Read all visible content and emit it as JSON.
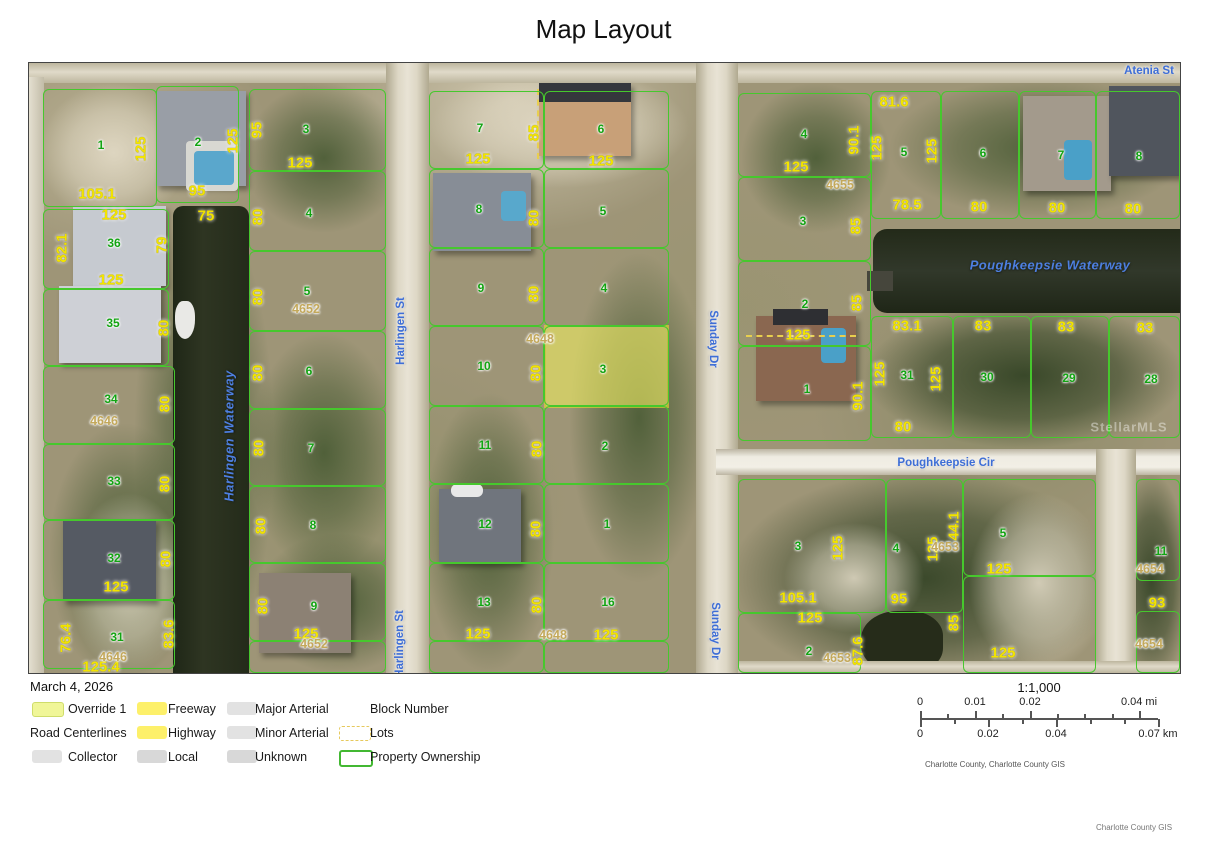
{
  "title": "Map Layout",
  "date": "March 4, 2026",
  "credits": {
    "map": "Charlotte County, Charlotte County GIS",
    "page": "Charlotte County GIS"
  },
  "scale_bar": {
    "ratio": "1:1,000",
    "mi_ticks": [
      "0",
      "0.01",
      "0.02",
      "0.04 mi"
    ],
    "km_ticks": [
      "0",
      "0.02",
      "0.04",
      "0.07 km"
    ]
  },
  "legend": {
    "rows": [
      [
        {
          "label": "Override 1",
          "swatch": "override"
        },
        {
          "label": "Freeway",
          "swatch": "yellow"
        },
        {
          "label": "Major Arterial",
          "swatch": "gray"
        },
        {
          "label": "Block Number",
          "swatch": "none"
        }
      ],
      [
        {
          "label": "Road Centerlines",
          "swatch": "title"
        },
        {
          "label": "Highway",
          "swatch": "yellow"
        },
        {
          "label": "Minor Arterial",
          "swatch": "gray"
        },
        {
          "label": "Lots",
          "swatch": "dashed"
        }
      ],
      [
        {
          "label": "Collector",
          "swatch": "gray"
        },
        {
          "label": "Local",
          "swatch": "gray2"
        },
        {
          "label": "Unknown",
          "swatch": "gray2"
        },
        {
          "label": "Property Ownership",
          "swatch": "green-outline"
        }
      ]
    ]
  },
  "colors": {
    "parcel_line": "#46c82d",
    "highlight_fill": "#ecea62",
    "highlight_border": "#e6df2e",
    "dimension_text": "#f2e400",
    "lot_number_text": "#12a412",
    "block_number_text": "#c3a85a",
    "street_text": "#3e6ed6",
    "water_text": "#4d7fe0",
    "water": "#262d1b",
    "legend_yellow": "#fdf06a",
    "legend_gray": "#e2e2e2"
  },
  "map": {
    "watermark": {
      "t": "StellarMLS",
      "x": 1100,
      "y": 364
    },
    "streets": [
      {
        "t": "Harlingen St",
        "x": 372,
        "y": 268,
        "r": -90
      },
      {
        "t": "Harlingen St",
        "x": 371,
        "y": 581,
        "r": -90
      },
      {
        "t": "Sunday Dr",
        "x": 684,
        "y": 276,
        "r": 90
      },
      {
        "t": "Sunday Dr",
        "x": 686,
        "y": 568,
        "r": 90
      },
      {
        "t": "Atenia St",
        "x": 1120,
        "y": 8,
        "r": 0
      },
      {
        "t": "Poughkeepsie Cir",
        "x": 917,
        "y": 400,
        "r": 0
      }
    ],
    "water_labels": [
      {
        "t": "Harlingen Waterway",
        "x": 200,
        "y": 373,
        "r": -90
      },
      {
        "t": "Poughkeepsie Waterway",
        "x": 1021,
        "y": 202,
        "r": 0
      }
    ],
    "lot_numbers": [
      {
        "t": "1",
        "x": 72,
        "y": 82
      },
      {
        "t": "2",
        "x": 169,
        "y": 79
      },
      {
        "t": "36",
        "x": 85,
        "y": 180
      },
      {
        "t": "35",
        "x": 84,
        "y": 260
      },
      {
        "t": "34",
        "x": 82,
        "y": 336
      },
      {
        "t": "33",
        "x": 85,
        "y": 418
      },
      {
        "t": "32",
        "x": 85,
        "y": 495
      },
      {
        "t": "31",
        "x": 88,
        "y": 574
      },
      {
        "t": "3",
        "x": 277,
        "y": 66
      },
      {
        "t": "4",
        "x": 280,
        "y": 150
      },
      {
        "t": "5",
        "x": 278,
        "y": 228
      },
      {
        "t": "6",
        "x": 280,
        "y": 308
      },
      {
        "t": "7",
        "x": 282,
        "y": 385
      },
      {
        "t": "8",
        "x": 284,
        "y": 462
      },
      {
        "t": "9",
        "x": 285,
        "y": 543
      },
      {
        "t": "7",
        "x": 451,
        "y": 65
      },
      {
        "t": "8",
        "x": 450,
        "y": 146
      },
      {
        "t": "9",
        "x": 452,
        "y": 225
      },
      {
        "t": "10",
        "x": 455,
        "y": 303
      },
      {
        "t": "11",
        "x": 456,
        "y": 382
      },
      {
        "t": "12",
        "x": 456,
        "y": 461
      },
      {
        "t": "13",
        "x": 455,
        "y": 539
      },
      {
        "t": "6",
        "x": 572,
        "y": 66
      },
      {
        "t": "5",
        "x": 574,
        "y": 148
      },
      {
        "t": "4",
        "x": 575,
        "y": 225
      },
      {
        "t": "3",
        "x": 574,
        "y": 306
      },
      {
        "t": "2",
        "x": 576,
        "y": 383
      },
      {
        "t": "1",
        "x": 578,
        "y": 461
      },
      {
        "t": "16",
        "x": 579,
        "y": 539
      },
      {
        "t": "4",
        "x": 775,
        "y": 71
      },
      {
        "t": "3",
        "x": 774,
        "y": 158
      },
      {
        "t": "2",
        "x": 776,
        "y": 241
      },
      {
        "t": "1",
        "x": 778,
        "y": 326
      },
      {
        "t": "5",
        "x": 875,
        "y": 89
      },
      {
        "t": "6",
        "x": 954,
        "y": 90
      },
      {
        "t": "7",
        "x": 1032,
        "y": 92
      },
      {
        "t": "8",
        "x": 1110,
        "y": 93
      },
      {
        "t": "31",
        "x": 878,
        "y": 312
      },
      {
        "t": "30",
        "x": 958,
        "y": 314
      },
      {
        "t": "29",
        "x": 1040,
        "y": 315
      },
      {
        "t": "28",
        "x": 1122,
        "y": 316
      },
      {
        "t": "3",
        "x": 769,
        "y": 483
      },
      {
        "t": "4",
        "x": 867,
        "y": 485
      },
      {
        "t": "5",
        "x": 974,
        "y": 470
      },
      {
        "t": "2",
        "x": 780,
        "y": 588
      },
      {
        "t": "11",
        "x": 1132,
        "y": 488
      }
    ],
    "dimensions": [
      {
        "t": "125",
        "x": 112,
        "y": 86,
        "r": -90
      },
      {
        "t": "105.1",
        "x": 68,
        "y": 131
      },
      {
        "t": "95",
        "x": 168,
        "y": 128
      },
      {
        "t": "125",
        "x": 204,
        "y": 78,
        "r": -90
      },
      {
        "t": "75",
        "x": 177,
        "y": 153
      },
      {
        "t": "82.1",
        "x": 33,
        "y": 185,
        "r": -90
      },
      {
        "t": "125",
        "x": 85,
        "y": 152
      },
      {
        "t": "125",
        "x": 82,
        "y": 217
      },
      {
        "t": "79",
        "x": 133,
        "y": 182,
        "r": -90
      },
      {
        "t": "80",
        "x": 135,
        "y": 265,
        "r": -90
      },
      {
        "t": "80",
        "x": 136,
        "y": 341,
        "r": -90
      },
      {
        "t": "80",
        "x": 136,
        "y": 421,
        "r": -90
      },
      {
        "t": "80",
        "x": 137,
        "y": 496,
        "r": -90
      },
      {
        "t": "125",
        "x": 87,
        "y": 524
      },
      {
        "t": "76.4",
        "x": 37,
        "y": 575,
        "r": -90
      },
      {
        "t": "83.6",
        "x": 140,
        "y": 571,
        "r": -90
      },
      {
        "t": "125.4",
        "x": 72,
        "y": 604
      },
      {
        "t": "95",
        "x": 228,
        "y": 67,
        "r": -90
      },
      {
        "t": "125",
        "x": 271,
        "y": 100
      },
      {
        "t": "80",
        "x": 229,
        "y": 154,
        "r": -90
      },
      {
        "t": "80",
        "x": 229,
        "y": 234,
        "r": -90
      },
      {
        "t": "80",
        "x": 229,
        "y": 310,
        "r": -90
      },
      {
        "t": "80",
        "x": 230,
        "y": 385,
        "r": -90
      },
      {
        "t": "80",
        "x": 232,
        "y": 463,
        "r": -90
      },
      {
        "t": "80",
        "x": 234,
        "y": 543,
        "r": -90
      },
      {
        "t": "125",
        "x": 277,
        "y": 571
      },
      {
        "t": "125",
        "x": 449,
        "y": 96
      },
      {
        "t": "85",
        "x": 505,
        "y": 70,
        "r": -90
      },
      {
        "t": "125",
        "x": 572,
        "y": 98
      },
      {
        "t": "80",
        "x": 505,
        "y": 155,
        "r": -90
      },
      {
        "t": "80",
        "x": 505,
        "y": 231,
        "r": -90
      },
      {
        "t": "80",
        "x": 507,
        "y": 310,
        "r": -90
      },
      {
        "t": "80",
        "x": 508,
        "y": 386,
        "r": -90
      },
      {
        "t": "80",
        "x": 507,
        "y": 466,
        "r": -90
      },
      {
        "t": "80",
        "x": 508,
        "y": 542,
        "r": -90
      },
      {
        "t": "125",
        "x": 449,
        "y": 571
      },
      {
        "t": "125",
        "x": 577,
        "y": 572
      },
      {
        "t": "125",
        "x": 767,
        "y": 104
      },
      {
        "t": "90.1",
        "x": 825,
        "y": 77,
        "r": -90
      },
      {
        "t": "81.6",
        "x": 865,
        "y": 39
      },
      {
        "t": "125",
        "x": 848,
        "y": 85,
        "r": -90
      },
      {
        "t": "125",
        "x": 903,
        "y": 88,
        "r": -90
      },
      {
        "t": "78.5",
        "x": 878,
        "y": 142
      },
      {
        "t": "80",
        "x": 950,
        "y": 144
      },
      {
        "t": "80",
        "x": 1028,
        "y": 145
      },
      {
        "t": "80",
        "x": 1104,
        "y": 146
      },
      {
        "t": "85",
        "x": 827,
        "y": 163,
        "r": -90
      },
      {
        "t": "85",
        "x": 828,
        "y": 240,
        "r": -90
      },
      {
        "t": "125",
        "x": 769,
        "y": 272
      },
      {
        "t": "90.1",
        "x": 829,
        "y": 333,
        "r": -90
      },
      {
        "t": "125",
        "x": 851,
        "y": 311,
        "r": -90
      },
      {
        "t": "125",
        "x": 907,
        "y": 316,
        "r": -90
      },
      {
        "t": "83.1",
        "x": 878,
        "y": 263
      },
      {
        "t": "83",
        "x": 954,
        "y": 263
      },
      {
        "t": "83",
        "x": 1037,
        "y": 264
      },
      {
        "t": "83",
        "x": 1116,
        "y": 265
      },
      {
        "t": "80",
        "x": 874,
        "y": 364
      },
      {
        "t": "125",
        "x": 809,
        "y": 485,
        "r": -90
      },
      {
        "t": "125",
        "x": 904,
        "y": 486,
        "r": -90
      },
      {
        "t": "44.1",
        "x": 925,
        "y": 463,
        "r": -90
      },
      {
        "t": "105.1",
        "x": 769,
        "y": 535
      },
      {
        "t": "95",
        "x": 870,
        "y": 536
      },
      {
        "t": "125",
        "x": 781,
        "y": 555
      },
      {
        "t": "87.6",
        "x": 829,
        "y": 588,
        "r": -90
      },
      {
        "t": "85",
        "x": 925,
        "y": 560,
        "r": -90
      },
      {
        "t": "125",
        "x": 970,
        "y": 506
      },
      {
        "t": "125",
        "x": 974,
        "y": 590
      },
      {
        "t": "93",
        "x": 1128,
        "y": 540
      }
    ],
    "block_numbers": [
      {
        "t": "4652",
        "x": 277,
        "y": 246
      },
      {
        "t": "4646",
        "x": 75,
        "y": 358
      },
      {
        "t": "4646",
        "x": 84,
        "y": 594
      },
      {
        "t": "4652",
        "x": 285,
        "y": 581
      },
      {
        "t": "4648",
        "x": 511,
        "y": 276
      },
      {
        "t": "4648",
        "x": 524,
        "y": 572
      },
      {
        "t": "4655",
        "x": 811,
        "y": 122
      },
      {
        "t": "4653",
        "x": 916,
        "y": 484
      },
      {
        "t": "4653",
        "x": 808,
        "y": 595
      },
      {
        "t": "4654",
        "x": 1121,
        "y": 506
      },
      {
        "t": "4654",
        "x": 1120,
        "y": 581
      }
    ],
    "highlighted_lot": {
      "x": 515,
      "y": 262,
      "w": 125,
      "h": 83
    },
    "parcels_px": [
      [
        14,
        26,
        114,
        118
      ],
      [
        127,
        23,
        83,
        117
      ],
      [
        14,
        146,
        126,
        80
      ],
      [
        14,
        226,
        126,
        77
      ],
      [
        14,
        303,
        132,
        78
      ],
      [
        14,
        381,
        132,
        76
      ],
      [
        14,
        457,
        132,
        80
      ],
      [
        14,
        537,
        132,
        69
      ],
      [
        220,
        26,
        137,
        82
      ],
      [
        220,
        108,
        137,
        80
      ],
      [
        220,
        188,
        137,
        80
      ],
      [
        220,
        268,
        137,
        78
      ],
      [
        220,
        346,
        137,
        77
      ],
      [
        220,
        423,
        137,
        77
      ],
      [
        220,
        500,
        137,
        78
      ],
      [
        220,
        578,
        137,
        32
      ],
      [
        400,
        28,
        115,
        78
      ],
      [
        400,
        106,
        115,
        79
      ],
      [
        400,
        185,
        115,
        78
      ],
      [
        400,
        263,
        115,
        80
      ],
      [
        400,
        343,
        115,
        78
      ],
      [
        400,
        421,
        115,
        79
      ],
      [
        400,
        500,
        115,
        78
      ],
      [
        400,
        578,
        115,
        32
      ],
      [
        515,
        28,
        125,
        78
      ],
      [
        515,
        106,
        125,
        79
      ],
      [
        515,
        185,
        125,
        78
      ],
      [
        515,
        263,
        125,
        80
      ],
      [
        515,
        343,
        125,
        78
      ],
      [
        515,
        421,
        125,
        79
      ],
      [
        515,
        500,
        125,
        78
      ],
      [
        515,
        578,
        125,
        32
      ],
      [
        709,
        30,
        133,
        84
      ],
      [
        709,
        114,
        133,
        84
      ],
      [
        709,
        198,
        133,
        85
      ],
      [
        709,
        283,
        133,
        95
      ],
      [
        842,
        28,
        70,
        128
      ],
      [
        912,
        28,
        78,
        128
      ],
      [
        990,
        28,
        77,
        128
      ],
      [
        1067,
        28,
        84,
        128
      ],
      [
        842,
        253,
        82,
        122
      ],
      [
        924,
        253,
        78,
        122
      ],
      [
        1002,
        253,
        78,
        122
      ],
      [
        1080,
        253,
        71,
        122
      ],
      [
        709,
        416,
        148,
        134
      ],
      [
        857,
        416,
        77,
        134
      ],
      [
        934,
        416,
        133,
        97
      ],
      [
        934,
        513,
        133,
        97
      ],
      [
        709,
        550,
        123,
        60
      ],
      [
        1107,
        416,
        44,
        102
      ],
      [
        1107,
        548,
        44,
        62
      ]
    ]
  }
}
